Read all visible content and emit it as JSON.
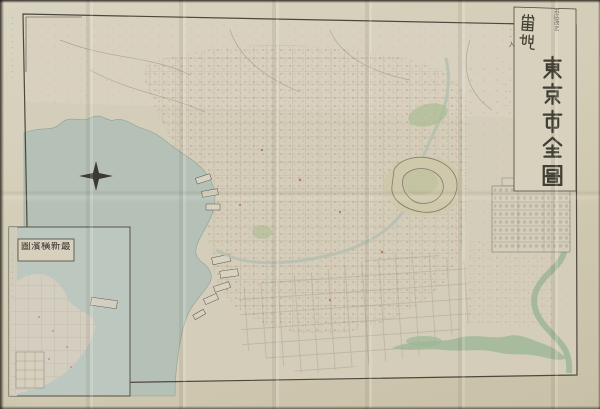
{
  "scene": {
    "description": "Photograph of a folded vintage Japanese map of Tokyo with a Yokohama inset",
    "background_color": "#201b15",
    "paper_color": "#d4cdb7"
  },
  "map": {
    "title": {
      "edition_note": "市區改正",
      "feature_note": "番地",
      "feature_note2": "··入",
      "main": "東京市全圖"
    },
    "inset": {
      "title_reading": "最新橫濱圖",
      "title_display": "圖濱橫新最",
      "margin_note": "········"
    },
    "notes": {
      "left_margin": "···········",
      "right_label": "····"
    },
    "colors": {
      "water": "#b5c1b7",
      "inset_water": "#bcc8bf",
      "river": "#9db695",
      "park": "#a9bb92",
      "urban_dot": "#b4705c",
      "ink": "#4c483c",
      "paper": "#d4cdb7"
    }
  }
}
